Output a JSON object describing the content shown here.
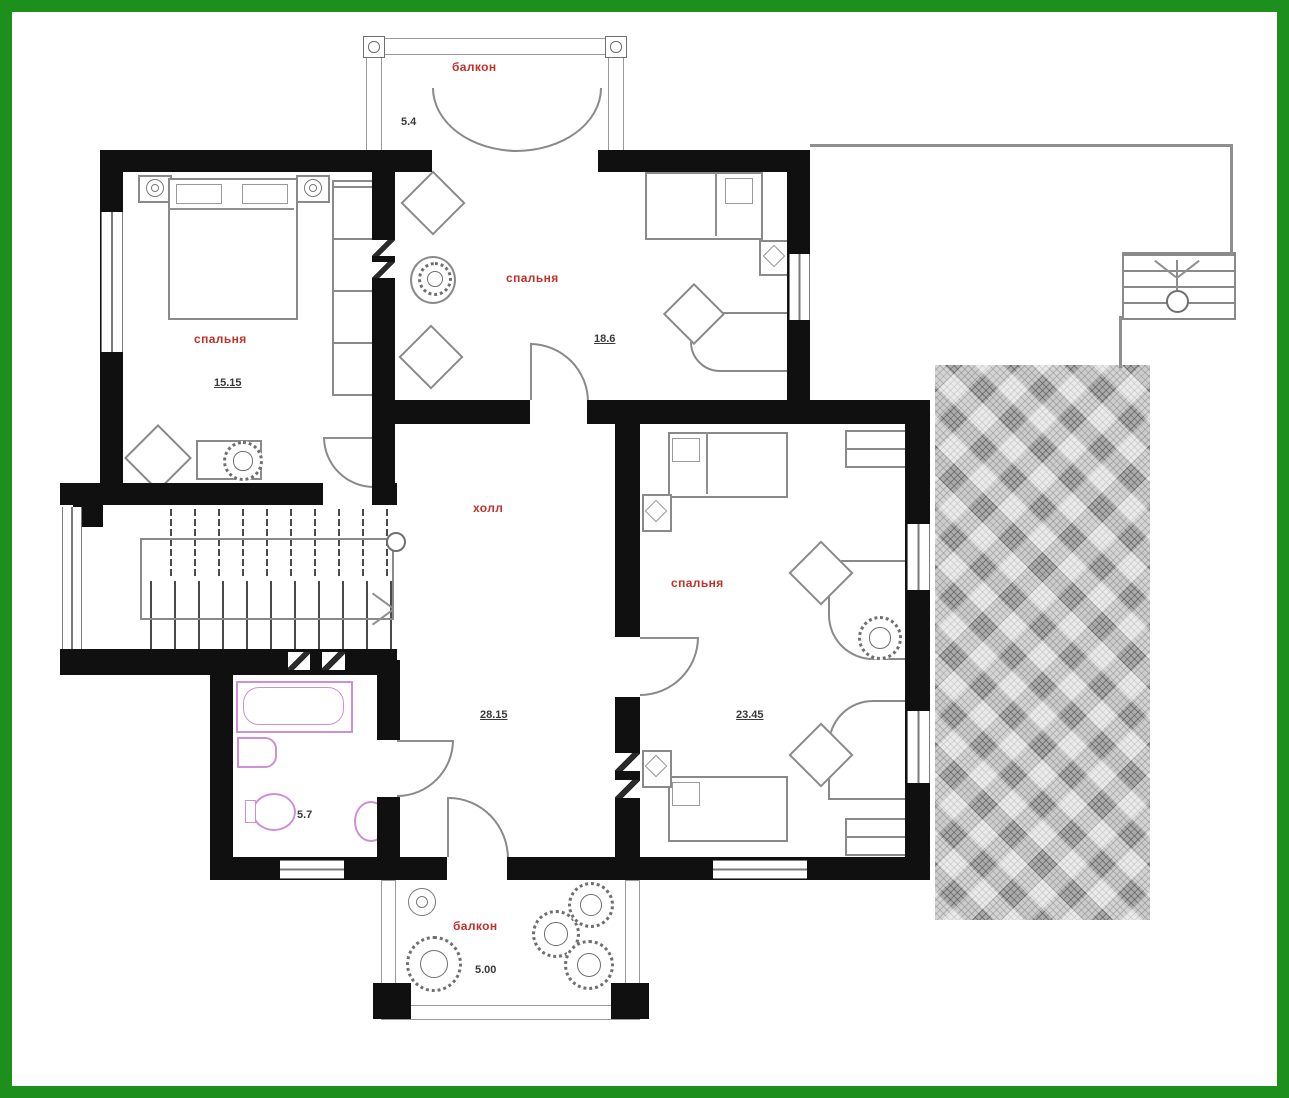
{
  "rooms": {
    "balcony_top": {
      "label": "балкон",
      "area": "5.4"
    },
    "bedroom_left": {
      "label": "спальня",
      "area": "15.15"
    },
    "bedroom_top": {
      "label": "спальня",
      "area": "18.6"
    },
    "hall": {
      "label": "холл",
      "area": "28.15"
    },
    "bedroom_right": {
      "label": "спальня",
      "area": "23.45"
    },
    "bathroom": {
      "area": "5.7"
    },
    "balcony_bottom": {
      "label": "балкон",
      "area": "5.00"
    }
  },
  "colors": {
    "frame_green": "#1d8f1d",
    "wall_black": "#101010",
    "room_label_red": "#c2302a",
    "area_text": "#3a3a3a",
    "fixture_pink": "#cf8fd6",
    "terrace_gray": "#c9c9c9"
  }
}
